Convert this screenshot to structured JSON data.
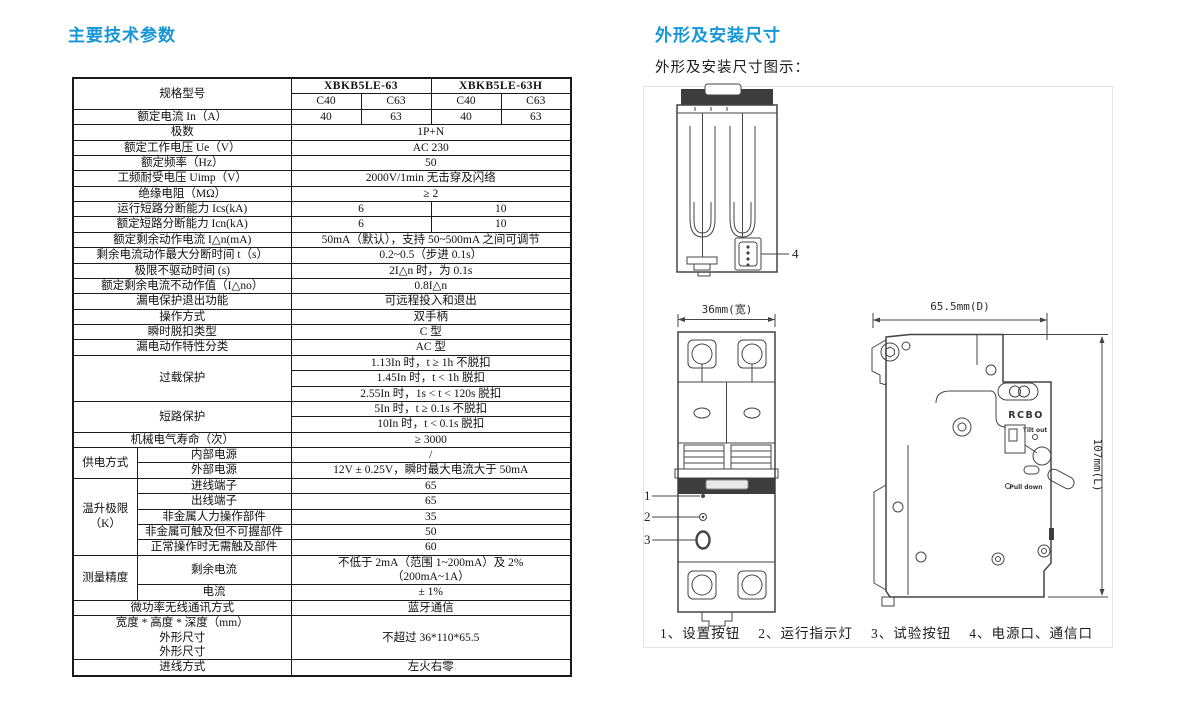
{
  "page": {
    "left_title": "主要技术参数",
    "right_title": "外形及安装尺寸",
    "right_subtitle": "外形及安装尺寸图示："
  },
  "colors": {
    "accent": "#1796d6",
    "line": "#454545",
    "dark": "#3d3d3d",
    "border": "#1a1a1a",
    "panel_border": "#e3e3e3"
  },
  "table": {
    "rows": [
      [
        {
          "t": "规格型号",
          "c": 2,
          "r": 2
        },
        {
          "t": "XBKB5LE-63",
          "c": 2,
          "k": "b"
        },
        {
          "t": "XBKB5LE-63H",
          "c": 2,
          "k": "b"
        }
      ],
      [
        {
          "t": "C40"
        },
        {
          "t": "C63"
        },
        {
          "t": "C40"
        },
        {
          "t": "C63"
        }
      ],
      [
        {
          "t": "额定电流 In（A）",
          "c": 2
        },
        {
          "t": "40"
        },
        {
          "t": "63"
        },
        {
          "t": "40"
        },
        {
          "t": "63"
        }
      ],
      [
        {
          "t": "极数",
          "c": 2
        },
        {
          "t": "1P+N",
          "c": 4
        }
      ],
      [
        {
          "t": "额定工作电压 Ue（V）",
          "c": 2
        },
        {
          "t": "AC 230",
          "c": 4
        }
      ],
      [
        {
          "t": "额定频率（Hz）",
          "c": 2
        },
        {
          "t": "50",
          "c": 4
        }
      ],
      [
        {
          "t": "工频耐受电压 Uimp（V）",
          "c": 2
        },
        {
          "t": "2000V/1min 无击穿及闪络",
          "c": 4
        }
      ],
      [
        {
          "t": "绝缘电阻（MΩ）",
          "c": 2
        },
        {
          "t": "≥ 2",
          "c": 4
        }
      ],
      [
        {
          "t": "运行短路分断能力 Ics(kA)",
          "c": 2
        },
        {
          "t": "6",
          "c": 2
        },
        {
          "t": "10",
          "c": 2
        }
      ],
      [
        {
          "t": "额定短路分断能力 Icn(kA)",
          "c": 2
        },
        {
          "t": "6",
          "c": 2
        },
        {
          "t": "10",
          "c": 2
        }
      ],
      [
        {
          "t": "额定剩余动作电流 I△n(mA)",
          "c": 2
        },
        {
          "t": "50mA（默认），支持 50~500mA 之间可调节",
          "c": 4
        }
      ],
      [
        {
          "t": "剩余电流动作最大分断时间 t（s）",
          "c": 2
        },
        {
          "t": "0.2~0.5（步进 0.1s）",
          "c": 4
        }
      ],
      [
        {
          "t": "极限不驱动时间 (s)",
          "c": 2
        },
        {
          "t": "2I△n 时，为 0.1s",
          "c": 4
        }
      ],
      [
        {
          "t": "额定剩余电流不动作值（I△no）",
          "c": 2
        },
        {
          "t": "0.8I△n",
          "c": 4
        }
      ],
      [
        {
          "t": "漏电保护退出功能",
          "c": 2
        },
        {
          "t": "可远程投入和退出",
          "c": 4
        }
      ],
      [
        {
          "t": "操作方式",
          "c": 2
        },
        {
          "t": "双手柄",
          "c": 4
        }
      ],
      [
        {
          "t": "瞬时脱扣类型",
          "c": 2
        },
        {
          "t": "C 型",
          "c": 4
        }
      ],
      [
        {
          "t": "漏电动作特性分类",
          "c": 2
        },
        {
          "t": "AC 型",
          "c": 4
        }
      ],
      [
        {
          "t": "过载保护",
          "c": 2,
          "r": 3
        },
        {
          "t": "1.13In 时，t ≥ 1h 不脱扣",
          "c": 4
        }
      ],
      [
        {
          "t": "1.45In 时，t < 1h 脱扣",
          "c": 4
        }
      ],
      [
        {
          "t": "2.55In 时，1s < t < 120s 脱扣",
          "c": 4
        }
      ],
      [
        {
          "t": "短路保护",
          "c": 2,
          "r": 2
        },
        {
          "t": "5In 时，t ≥ 0.1s 不脱扣",
          "c": 4
        }
      ],
      [
        {
          "t": "10In 时，t < 0.1s 脱扣",
          "c": 4
        }
      ],
      [
        {
          "t": "机械电气寿命（次）",
          "c": 2
        },
        {
          "t": "≥ 3000",
          "c": 4
        }
      ],
      [
        {
          "t": "供电方式",
          "r": 2
        },
        {
          "t": "内部电源"
        },
        {
          "t": "/",
          "c": 4
        }
      ],
      [
        {
          "t": "外部电源"
        },
        {
          "t": "12V ± 0.25V，瞬时最大电流大于 50mA",
          "c": 4
        }
      ],
      [
        {
          "t": "温升极限\n（K）",
          "r": 5
        },
        {
          "t": "进线端子"
        },
        {
          "t": "65",
          "c": 4
        }
      ],
      [
        {
          "t": "出线端子"
        },
        {
          "t": "65",
          "c": 4
        }
      ],
      [
        {
          "t": "非金属人力操作部件"
        },
        {
          "t": "35",
          "c": 4
        }
      ],
      [
        {
          "t": "非金属可触及但不可握部件"
        },
        {
          "t": "50",
          "c": 4
        }
      ],
      [
        {
          "t": "正常操作时无需触及部件"
        },
        {
          "t": "60",
          "c": 4
        }
      ],
      [
        {
          "t": "测量精度",
          "r": 2
        },
        {
          "t": "剩余电流"
        },
        {
          "t": "不低于 2mA（范围 1~200mA）及 2%\n（200mA~1A）",
          "c": 4
        }
      ],
      [
        {
          "t": "电流"
        },
        {
          "t": "± 1%",
          "c": 4
        }
      ],
      [
        {
          "t": "微功率无线通讯方式",
          "c": 2
        },
        {
          "t": "蓝牙通信",
          "c": 4
        }
      ],
      [
        {
          "t": "宽度 * 高度 * 深度（mm）\n外形尺寸\n外形尺寸",
          "c": 2
        },
        {
          "t": "不超过 36*110*65.5",
          "c": 4
        }
      ],
      [
        {
          "t": "进线方式",
          "c": 2
        },
        {
          "t": "左火右零",
          "c": 4
        }
      ]
    ]
  },
  "diagram": {
    "dims": {
      "width": "36mm(宽)",
      "depth": "65.5mm(D)",
      "height": "107mm(L)"
    },
    "labels": {
      "rcbo": "RCBO",
      "tilt_out": "Tilt out",
      "pull_down": "Pull down"
    },
    "callouts": {
      "c1": "1",
      "c2": "2",
      "c3": "3",
      "c4": "4"
    },
    "caption_items": [
      "1、设置按钮",
      "2、运行指示灯",
      "3、试验按钮",
      "4、电源口、通信口"
    ]
  }
}
